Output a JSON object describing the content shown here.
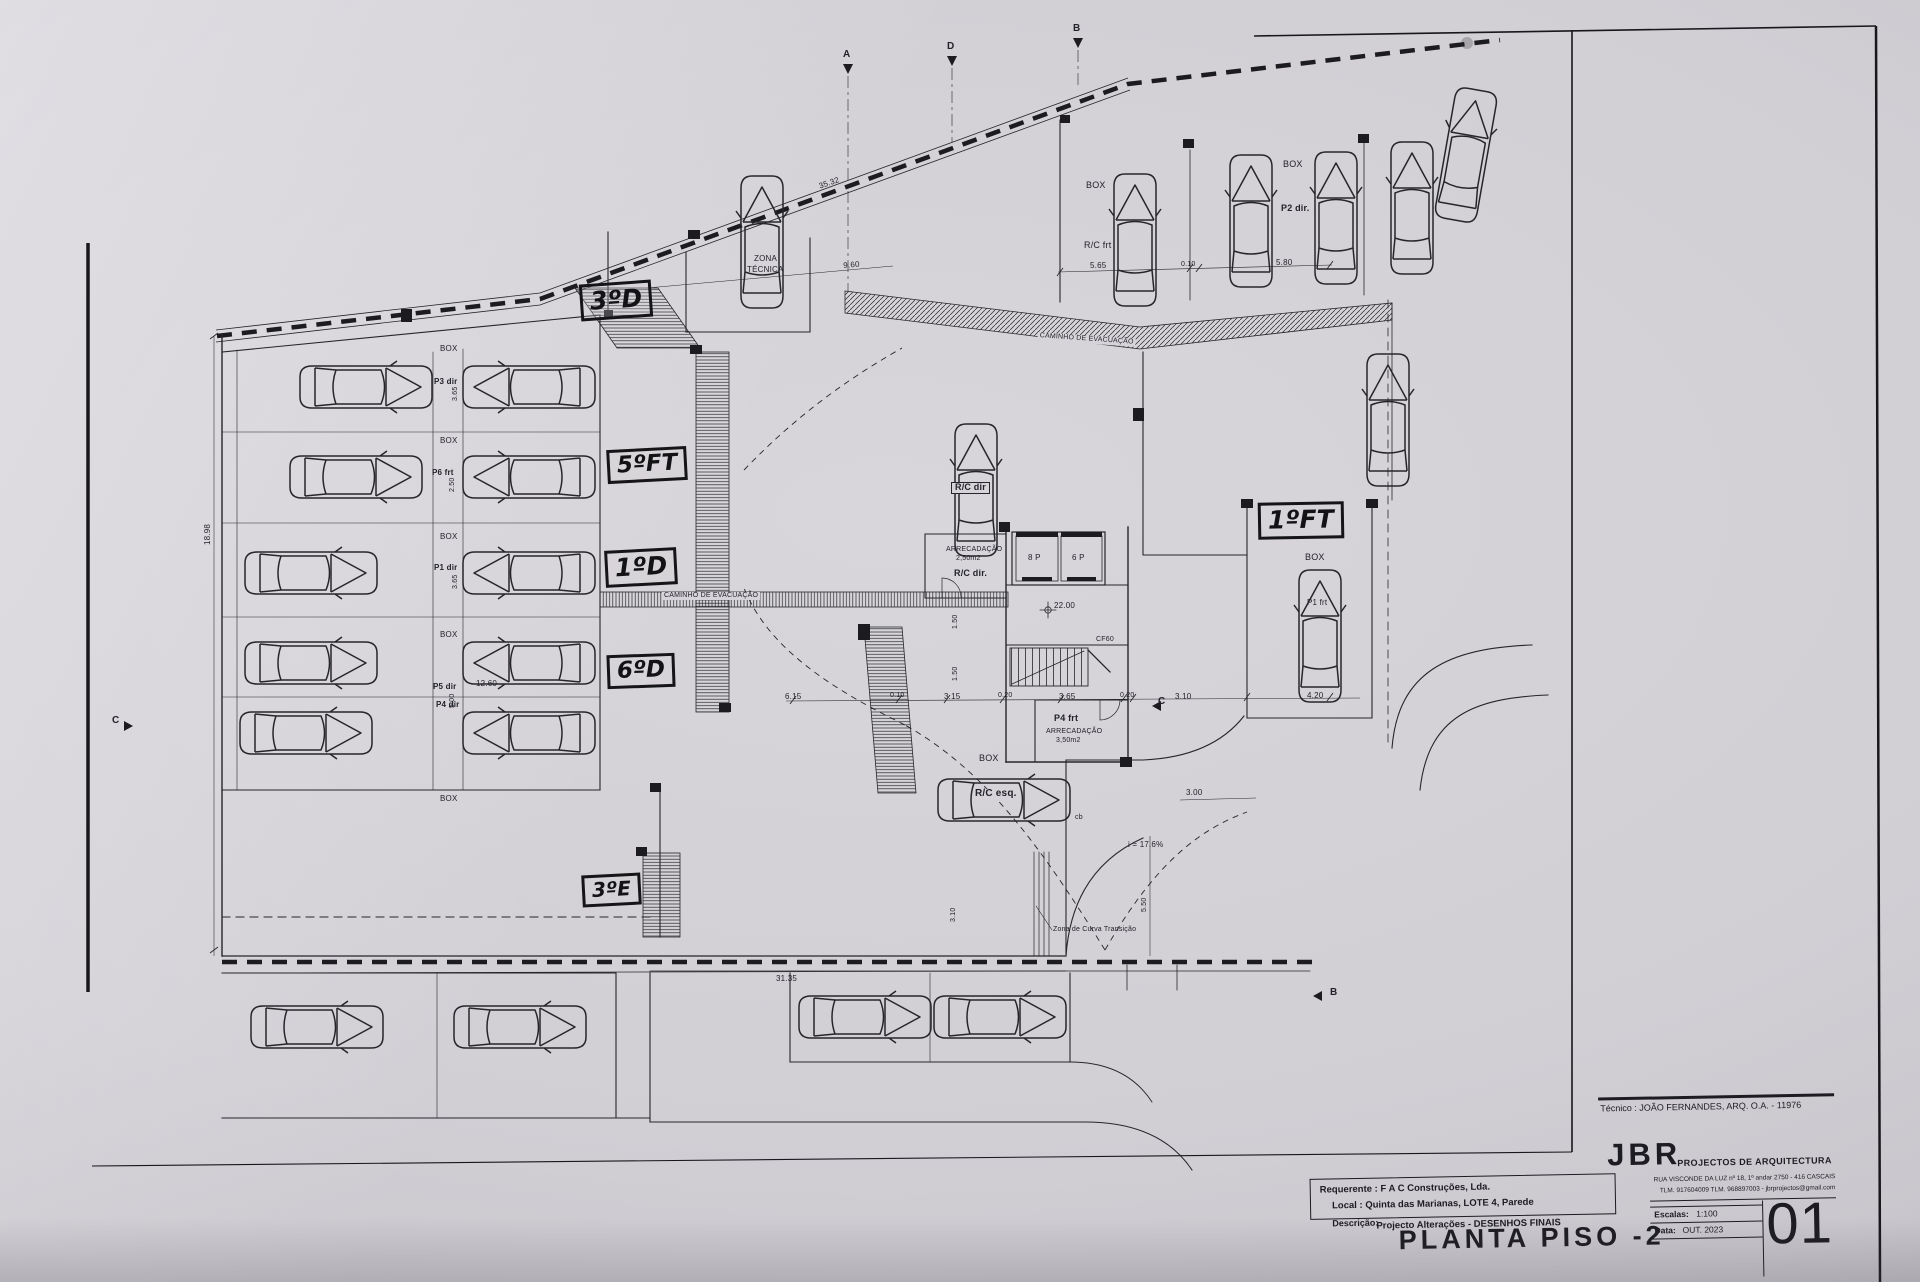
{
  "annotations": {
    "unit_3d": "3ºD",
    "unit_5ft": "5ºFT",
    "unit_1d": "1ºD",
    "unit_6d": "6ºD",
    "unit_3e": "3ºE",
    "unit_1ft": "1ºFT"
  },
  "labels": {
    "box": "BOX",
    "zona_tecnica_line1": "ZONA",
    "zona_tecnica_line2": "TÉCNICA",
    "caminho_evacuacao": "CAMINHO DE EVACUAÇÃO",
    "rc_frt": "R/C frt",
    "rc_dir_room": "R/C dir.",
    "rc_dir_car": "R/C dir",
    "rc_esq": "R/C esq.",
    "p2_dir": "P2 dir.",
    "p3_dir": "P3 dir",
    "p6_frt": "P6 frt",
    "p1_dir": "P1 dir",
    "p5_dir": "P5 dir",
    "p4_dir": "P4 dir",
    "p1_frt": "P1 frt",
    "p4_frt": "P4 frt",
    "arrecadacao": "ARRECADAÇÃO",
    "area_2_50": "2,50m2",
    "area_3_50": "3,50m2",
    "lift_8p": "8 P",
    "lift_6p": "6 P",
    "level_mark": "22.00",
    "door_cf60": "CF60",
    "slope": "i = 17.6%",
    "curve_zone": "Zona de Curva Transição",
    "sec_a": "A",
    "sec_b": "B",
    "sec_c": "C",
    "sec_d": "D",
    "sec_cb": "cb"
  },
  "dims": {
    "d35_32": "35.32",
    "d9_60": "9.60",
    "d5_65": "5.65",
    "d0_10": "0.10",
    "d5_80": "5.80",
    "d31_35": "31.35",
    "d18_98": "18.98",
    "d12_60": "12.60",
    "d6_15": "6.15",
    "d3_15": "3.15",
    "d3_65": "3.65",
    "d0_20": "0.20",
    "d1_50": "1.50",
    "d3_10": "3.10",
    "d4_20": "4.20",
    "d3_00": "3.00",
    "d5_50": "5.50",
    "d5_00": "5.00",
    "d2_50": "2.50"
  },
  "title_block": {
    "tecnico": "Técnico : JOÃO FERNANDES, ARQ.   O.A. - 11976",
    "firm_initials": "JBR",
    "firm_name": "PROJECTOS DE ARQUITECTURA",
    "firm_address": "RUA VISCONDE DA LUZ nº 18, 1º andar  2750 - 416 CASCAIS",
    "firm_contacts": "TLM. 917604009  TLM. 968897003 - jbrprojectos@gmail.com",
    "requerente": "Requerente : F A C  Construções, Lda.",
    "local": "Local : Quinta das Marianas, LOTE 4, Parede",
    "descricao_label": "Descrição:",
    "descricao": "Projecto Alterações - DESENHOS FINAIS",
    "drawing_title": "PLANTA PISO -2",
    "escalas_label": "Escalas:",
    "escalas_value": "1:100",
    "data_label": "Data:",
    "data_value": "OUT. 2023",
    "sheet_number": "01"
  }
}
